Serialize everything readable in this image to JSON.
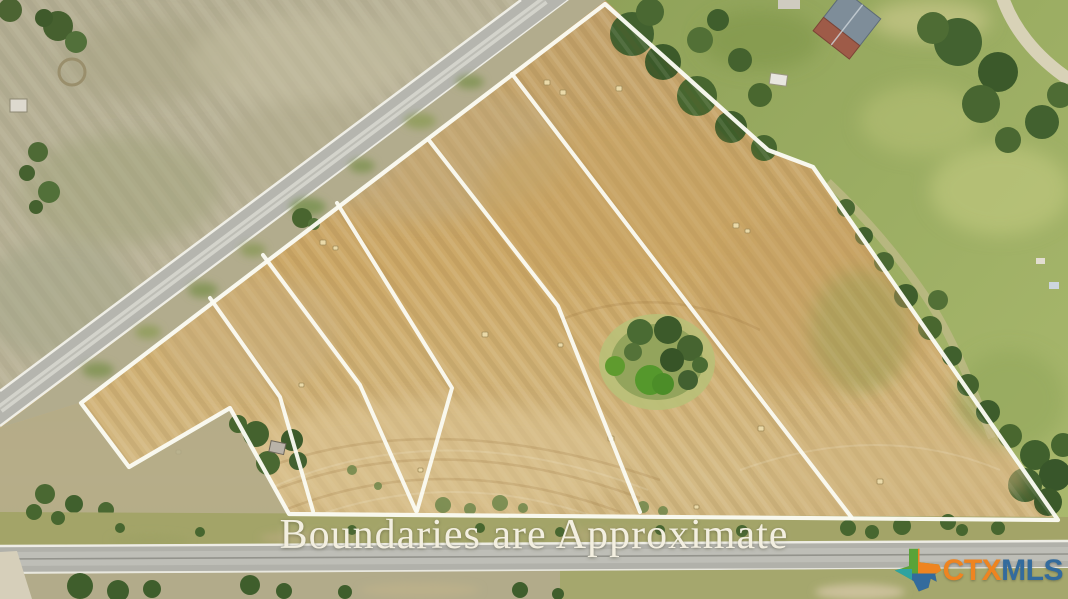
{
  "overlay": {
    "caption": "Boundaries are Approximate",
    "logo": {
      "icon": "texas-state-icon",
      "prefix": "CTX",
      "suffix": "MLS"
    }
  },
  "palette": {
    "boundary_line": "#fbfbf2",
    "field_tan": "#c9a76e",
    "pasture_khaki": "#b7b197",
    "greenbelt": "#9aab60",
    "tree_dark": "#44622e",
    "road_gray": "#b5b5ae",
    "caption_text": "#f3efe0",
    "logo_orange": "#ee8420",
    "logo_blue": "#336b9d",
    "logo_green": "#5aa338",
    "logo_teal": "#2fa3a0"
  },
  "boundaries": {
    "outer": [
      [
        605,
        4
      ],
      [
        690,
        80
      ],
      [
        768,
        150
      ],
      [
        813,
        167
      ],
      [
        1058,
        520
      ],
      [
        289,
        514
      ],
      [
        230,
        408
      ],
      [
        129,
        467
      ],
      [
        81,
        403
      ]
    ],
    "interior": [
      [
        [
          512,
          74
        ],
        [
          648,
          252
        ],
        [
          852,
          518
        ]
      ],
      [
        [
          428,
          139
        ],
        [
          558,
          306
        ],
        [
          640,
          512
        ]
      ],
      [
        [
          337,
          203
        ],
        [
          452,
          388
        ],
        [
          417,
          511
        ]
      ],
      [
        [
          263,
          255
        ],
        [
          360,
          385
        ],
        [
          416,
          511
        ]
      ],
      [
        [
          210,
          298
        ],
        [
          280,
          397
        ],
        [
          313,
          511
        ]
      ]
    ]
  }
}
